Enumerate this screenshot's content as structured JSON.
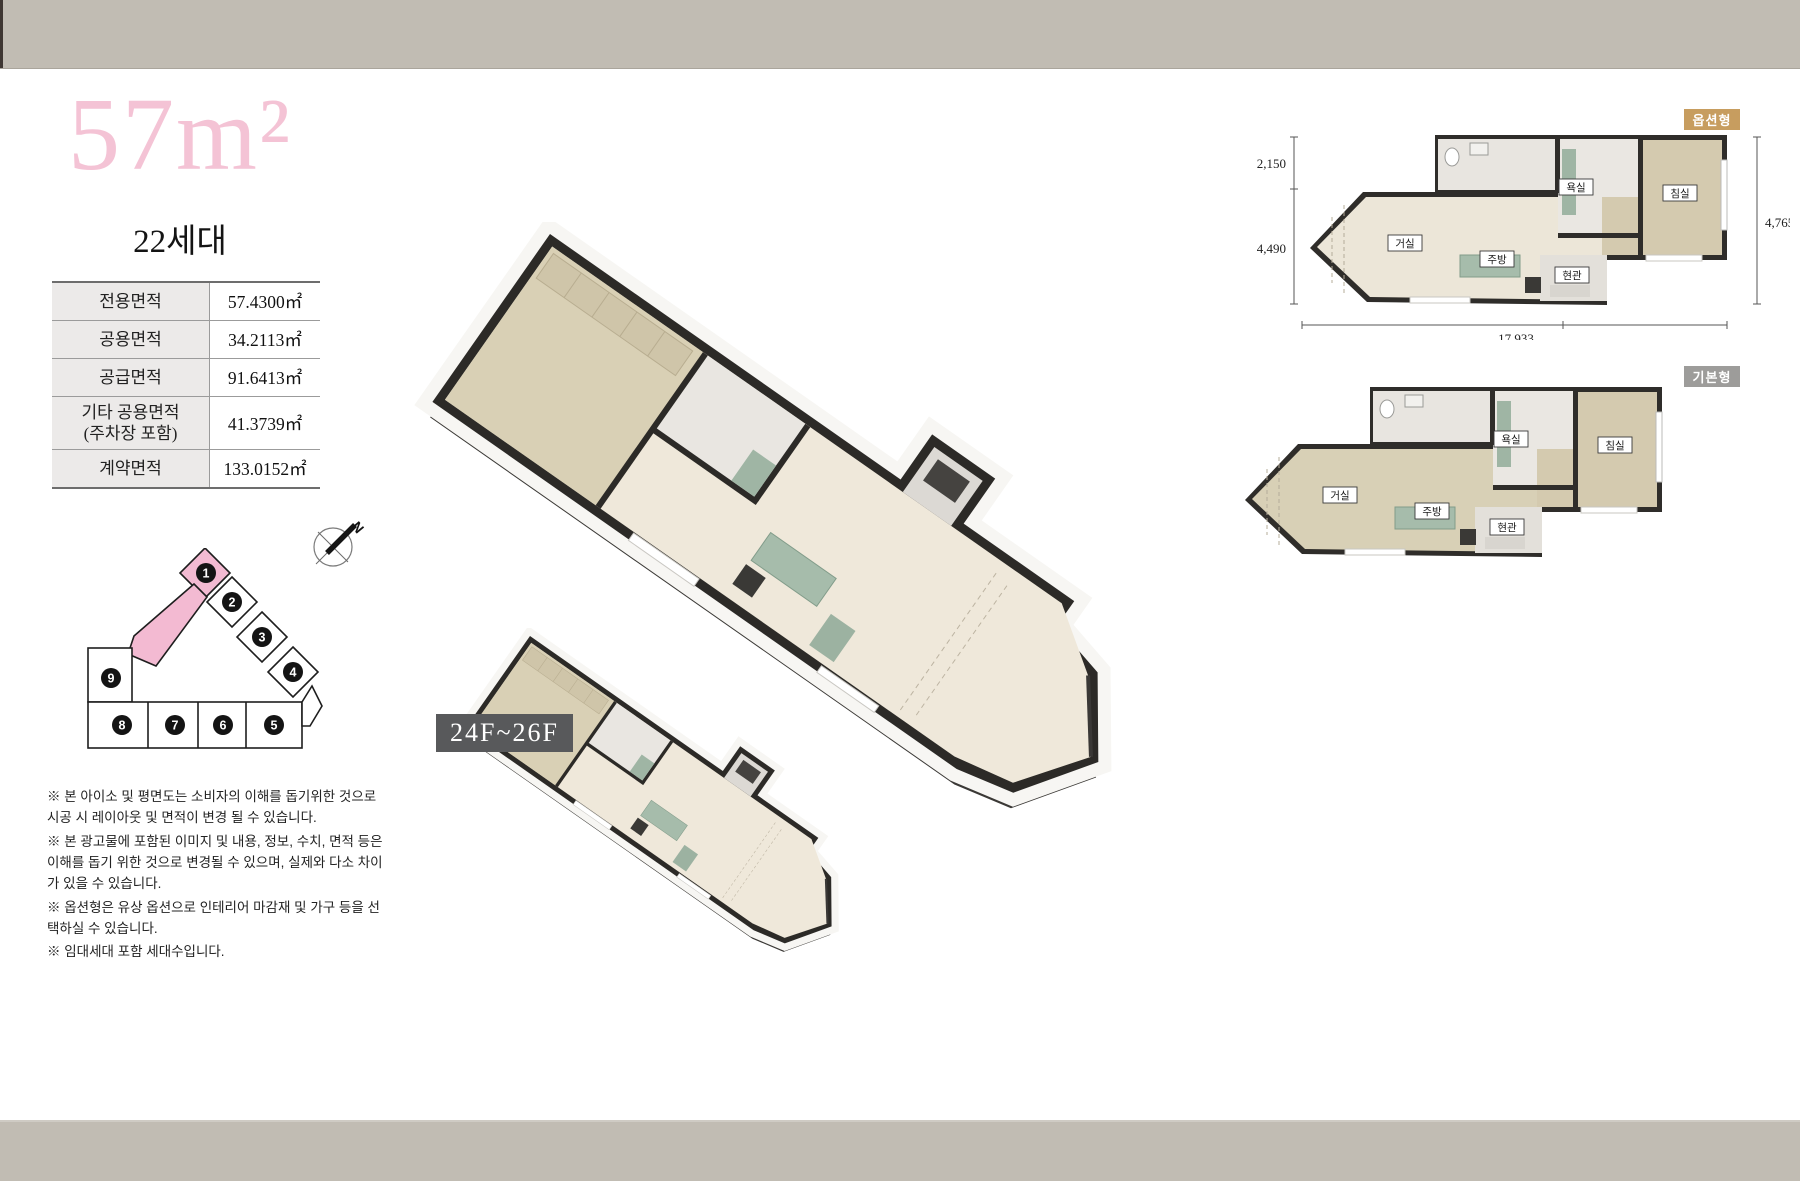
{
  "colors": {
    "band": "#c1bcb3",
    "title_pink": "#f4c3d5",
    "unit_highlight": "#f3bad2",
    "badge_gold": "#c79d5f",
    "badge_gray": "#9d9c9a",
    "floor_badge_bg": "#58595b",
    "wall_dark": "#2c2a27",
    "floor_cream": "#ece6d8",
    "floor_tan": "#d4caaf"
  },
  "header": {
    "title": "57m²",
    "units_count": "22세대"
  },
  "area_table": {
    "rows": [
      {
        "label": "전용면적",
        "value": "57.4300㎡"
      },
      {
        "label": "공용면적",
        "value": "34.2113㎡"
      },
      {
        "label": "공급면적",
        "value": "91.6413㎡"
      },
      {
        "label": "기타 공용면적\n(주차장 포함)",
        "value": "41.3739㎡"
      },
      {
        "label": "계약면적",
        "value": "133.0152㎡"
      }
    ]
  },
  "site_map": {
    "north_label": "N",
    "highlighted_unit": "1",
    "units": [
      "1",
      "2",
      "3",
      "4",
      "5",
      "6",
      "7",
      "8",
      "9"
    ]
  },
  "floor_badge": {
    "label": "24F~26F"
  },
  "plans": {
    "room_labels": {
      "living": "거실",
      "kitchen": "주방",
      "entrance": "현관",
      "bath": "욕실",
      "bedroom": "침실"
    },
    "option": {
      "badge": "옵션형",
      "dim_left_top": "2,150",
      "dim_left_bottom": "4,490",
      "dim_right": "4,765",
      "dim_bottom": "17,933"
    },
    "basic": {
      "badge": "기본형"
    }
  },
  "disclaimers": [
    "※ 본 아이소 및 평면도는 소비자의 이해를 돕기위한 것으로 시공 시 레이아웃 및 면적이 변경 될 수 있습니다.",
    "※ 본 광고물에 포함된 이미지 및 내용, 정보, 수치, 면적 등은 이해를 돕기 위한 것으로 변경될 수 있으며, 실제와 다소 차이가 있을 수 있습니다.",
    "※ 옵션형은 유상 옵션으로 인테리어 마감재 및 가구 등을 선택하실 수 있습니다.",
    "※ 임대세대 포함 세대수입니다."
  ]
}
